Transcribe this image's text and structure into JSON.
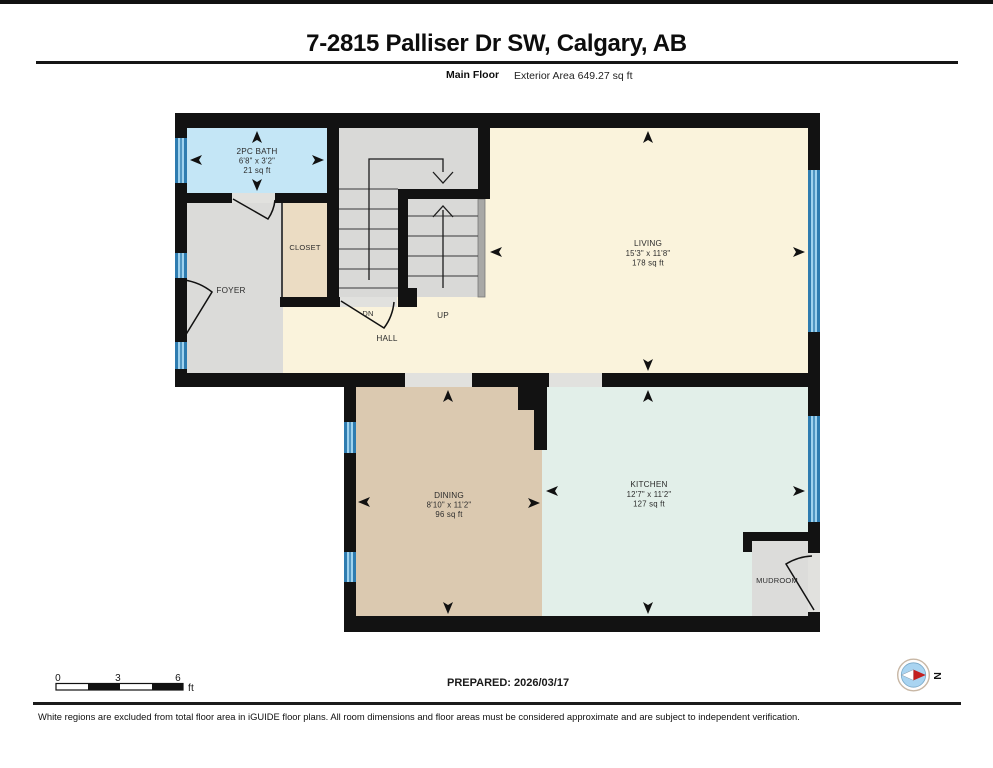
{
  "header": {
    "title": "7-2815 Palliser Dr SW, Calgary, AB",
    "floor_label": "Main Floor",
    "area_label": "Exterior Area 649.27 sq ft"
  },
  "plan": {
    "rooms": {
      "bath": {
        "name": "2PC BATH",
        "dims": "6'8\" x 3'2\"",
        "area": "21 sq ft"
      },
      "closet": {
        "name": "CLOSET"
      },
      "foyer": {
        "name": "FOYER"
      },
      "stairs": {
        "down_label": "DN",
        "up_label": "UP"
      },
      "hall": {
        "name": "HALL"
      },
      "living": {
        "name": "LIVING",
        "dims": "15'3\" x 11'8\"",
        "area": "178 sq ft"
      },
      "dining": {
        "name": "DINING",
        "dims": "8'10\" x 11'2\"",
        "area": "96 sq ft"
      },
      "kitchen": {
        "name": "KITCHEN",
        "dims": "12'7\" x 11'2\"",
        "area": "127 sq ft"
      },
      "mudroom": {
        "name": "MUDROOM"
      }
    }
  },
  "footer": {
    "scale_bar": {
      "ticks": [
        "0",
        "3",
        "6"
      ],
      "unit": "ft"
    },
    "prepared": "PREPARED: 2026/03/17",
    "compass": {
      "north_label": "N"
    },
    "disclaimer": "White regions are excluded from total floor area in iGUIDE floor plans. All room dimensions and floor areas must be considered approximate and are subject to independent verification."
  },
  "colors": {
    "wall": "#121212",
    "threshold": "#e1e1de",
    "floor_bath": "#c4e6f6",
    "floor_foyer": "#dbdbd9",
    "floor_closet": "#ebdcc3",
    "floor_stairs": "#d9d9d7",
    "floor_living": "#faf3dc",
    "floor_dining": "#dbc9b0",
    "floor_kitchen": "#e2efe9",
    "floor_mudroom": "#dcdcda",
    "stair_rail": "#a8a8a6",
    "window_dark": "#2e7cb0",
    "window_light": "#9fd2ee",
    "compass_red": "#c32020"
  }
}
